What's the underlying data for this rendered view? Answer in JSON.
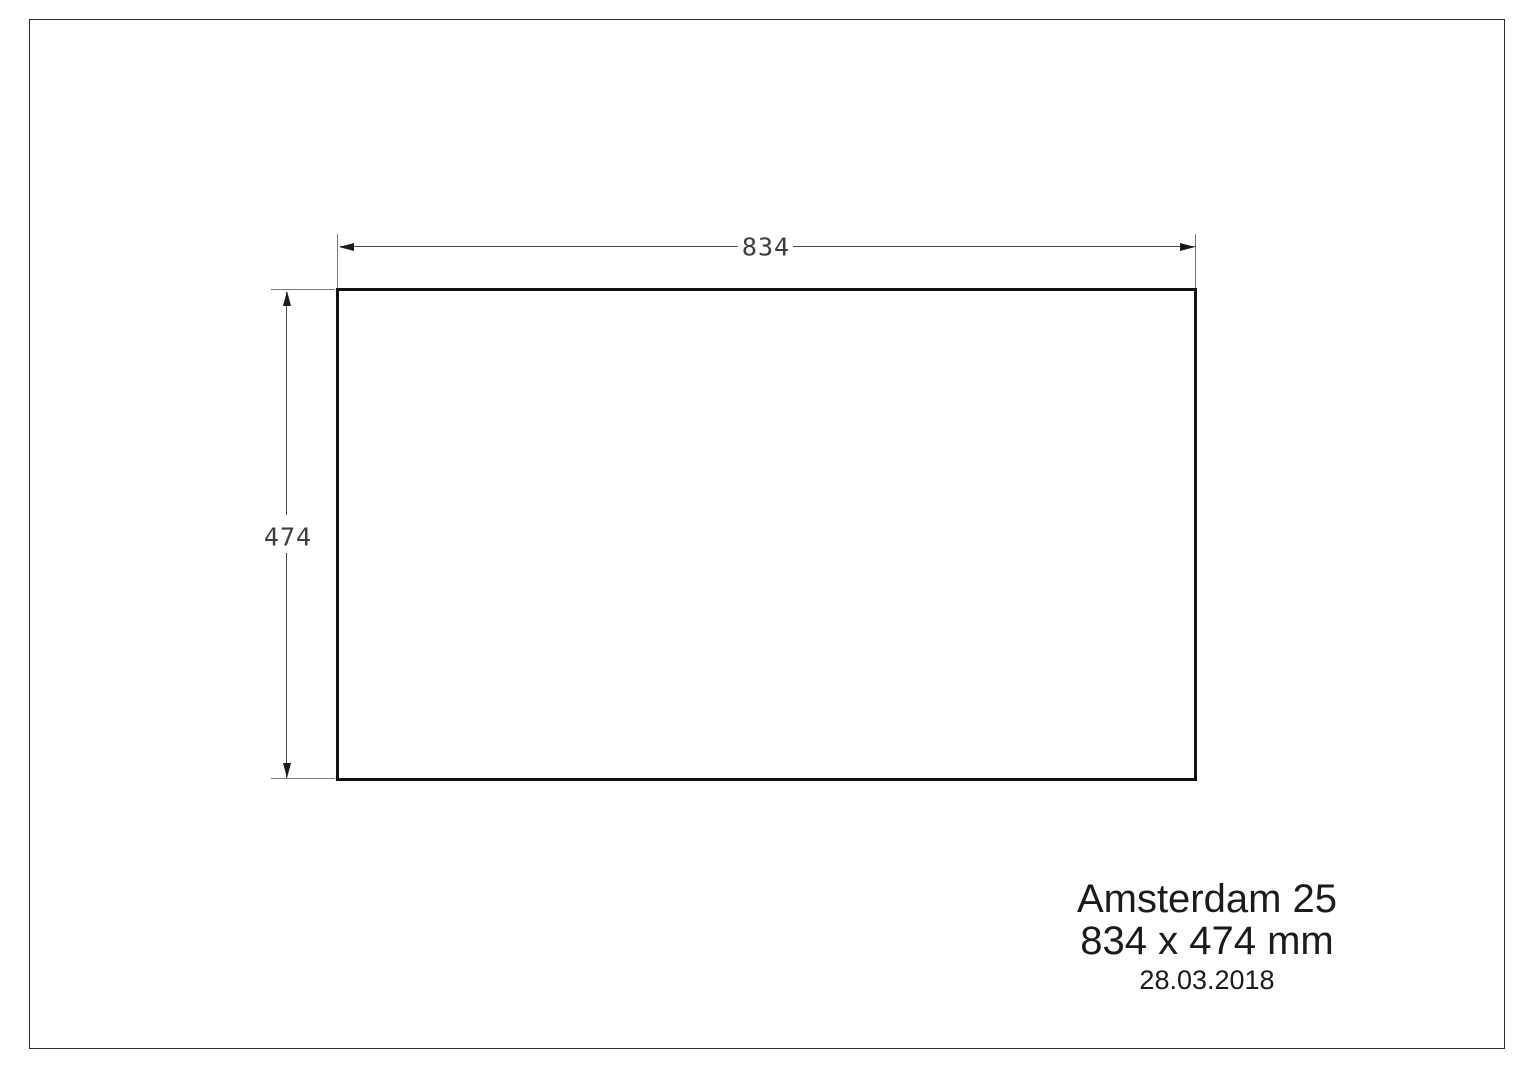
{
  "colors": {
    "paper": "#ffffff",
    "frame-border": "#2e2e2e",
    "outline": "#111111",
    "dim-line": "#4a4a4a",
    "ext-line": "#777777",
    "dim-text": "#3d3d3d",
    "arrow": "#1a1a1a",
    "title-text": "#1b1b1b"
  },
  "drawing": {
    "product_outline": "rectangle",
    "dimensions": {
      "width_label": "834",
      "height_label": "474"
    }
  },
  "title_block": {
    "model": "Amsterdam 25",
    "size": "834 x 474 mm",
    "date": "28.03.2018"
  }
}
